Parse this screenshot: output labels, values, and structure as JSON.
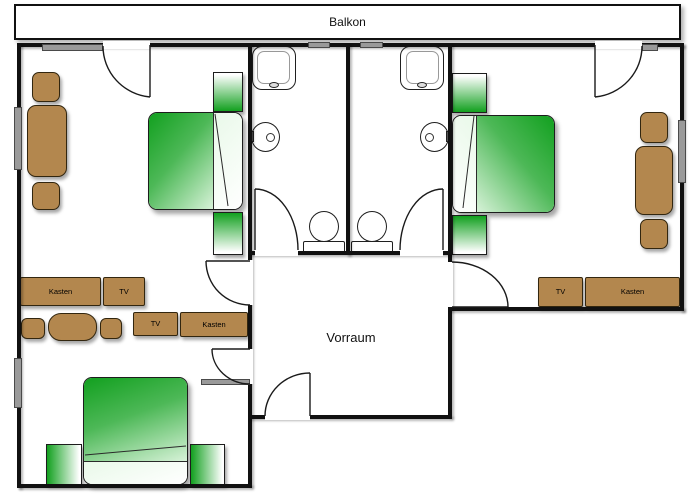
{
  "plan": {
    "balcony_label": "Balkon",
    "hallway_label": "Vorraum"
  },
  "furniture_labels": {
    "room_upper_left": {
      "kasten": "Kasten",
      "tv": "TV"
    },
    "room_lower_left": {
      "kasten": "Kasten",
      "tv": "TV"
    },
    "room_right": {
      "kasten": "Kasten",
      "tv": "TV"
    }
  },
  "colors": {
    "wall": "#111111",
    "furniture_brown": "#b3874e",
    "bed_green": "#12a01f",
    "bed_green_mid": "#4db857",
    "bed_green_light": "#d7f2d8",
    "window_gray": "#9a9a9a",
    "background": "#ffffff"
  }
}
